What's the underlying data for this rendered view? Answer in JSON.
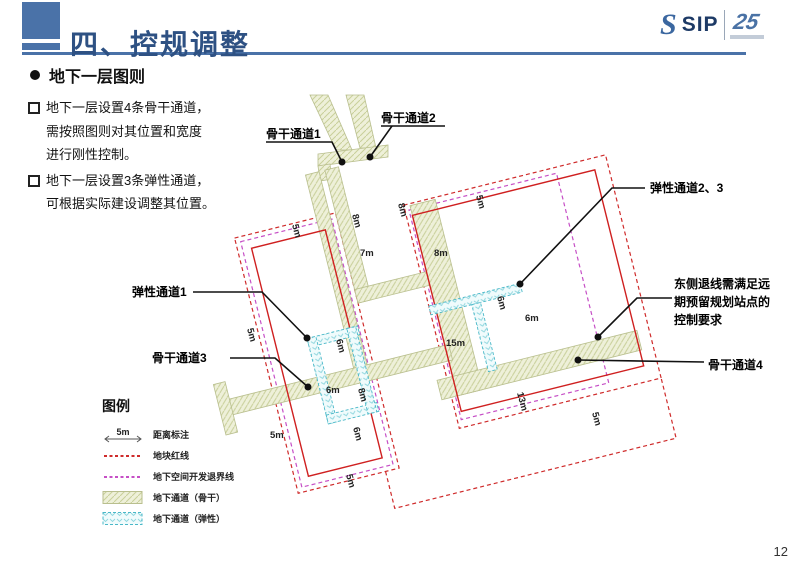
{
  "header": {
    "title": "四、控规调整",
    "logo_s": "S",
    "logo_text": "SIP",
    "logo_badge": "25"
  },
  "section": {
    "title": "地下一层图则"
  },
  "notes": {
    "items": [
      {
        "lines": [
          "地下一层设置4条骨干通道，",
          "需按照图则对其位置和宽度",
          "进行刚性控制。"
        ]
      },
      {
        "lines": [
          "地下一层设置3条弹性通道，",
          "可根据实际建设调整其位置。"
        ]
      }
    ]
  },
  "map": {
    "callouts": {
      "trunk1": "骨干通道1",
      "trunk2": "骨干通道2",
      "trunk3": "骨干通道3",
      "trunk4": "骨干通道4",
      "flex1": "弹性通道1",
      "flex23": "弹性通道2、3",
      "east_lines": [
        "东侧退线需满足远",
        "期预留规划站点的",
        "控制要求"
      ]
    },
    "dimensions": [
      {
        "text": "5m"
      },
      {
        "text": "8m"
      },
      {
        "text": "8m"
      },
      {
        "text": "5m"
      },
      {
        "text": "7m"
      },
      {
        "text": "8m"
      },
      {
        "text": "6m"
      },
      {
        "text": "6m"
      },
      {
        "text": "15m"
      },
      {
        "text": "6m"
      },
      {
        "text": "6m"
      },
      {
        "text": "8m"
      },
      {
        "text": "6m"
      },
      {
        "text": "5m"
      },
      {
        "text": "5m"
      },
      {
        "text": "13m"
      },
      {
        "text": "5m"
      },
      {
        "text": "5m"
      }
    ]
  },
  "legend": {
    "title": "图例",
    "distance_value": "5m",
    "items": [
      {
        "label": "距离标注"
      },
      {
        "label": "地块红线"
      },
      {
        "label": "地下空间开发退界线"
      },
      {
        "label": "地下通道（骨干）"
      },
      {
        "label": "地下通道（弹性）"
      }
    ]
  },
  "colors": {
    "accent_blue": "#4a72a8",
    "title_blue": "#2e5183",
    "red_line": "#cf2020",
    "red_dashed": "#cf2b2b",
    "magenta_dashed": "#c64fc6",
    "trunk_fill": "#eef0d9",
    "flex_stroke": "#49b8c8"
  },
  "page_number": "12"
}
